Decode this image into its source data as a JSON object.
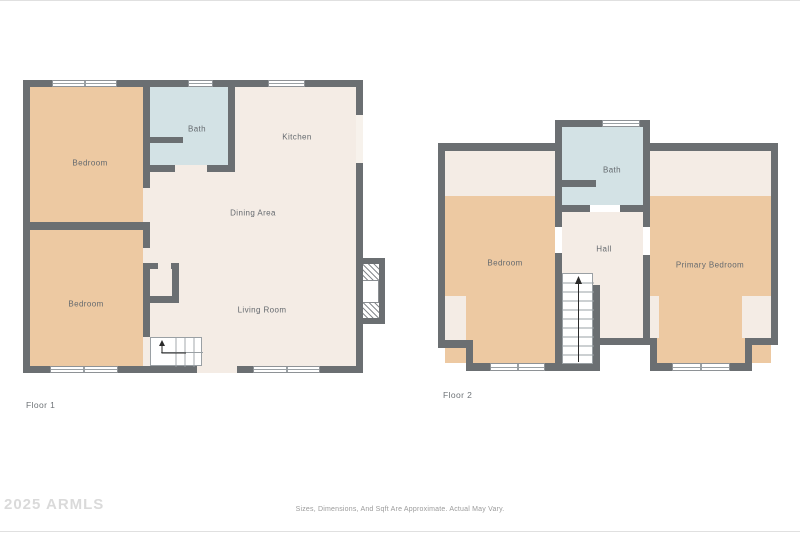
{
  "colors": {
    "wall": "#6b6f72",
    "bedroom": "#edc9a2",
    "bath": "#d3e2e5",
    "living": "#f4ece5",
    "label": "#64696e",
    "watermark": "#dadada",
    "disclaimer": "#9b9b9b"
  },
  "floor1": {
    "label": "Floor 1",
    "rooms": {
      "bedroom_top": "Bedroom",
      "bedroom_bottom": "Bedroom",
      "bath": "Bath",
      "kitchen": "Kitchen",
      "dining": "Dining Area",
      "living": "Living Room"
    }
  },
  "floor2": {
    "label": "Floor 2",
    "rooms": {
      "bedroom": "Bedroom",
      "bath": "Bath",
      "hall": "Hall",
      "primary": "Primary Bedroom"
    }
  },
  "footer": {
    "watermark": "2025 ARMLS",
    "disclaimer": "Sizes, Dimensions, And Sqft Are Approximate. Actual May Vary."
  }
}
